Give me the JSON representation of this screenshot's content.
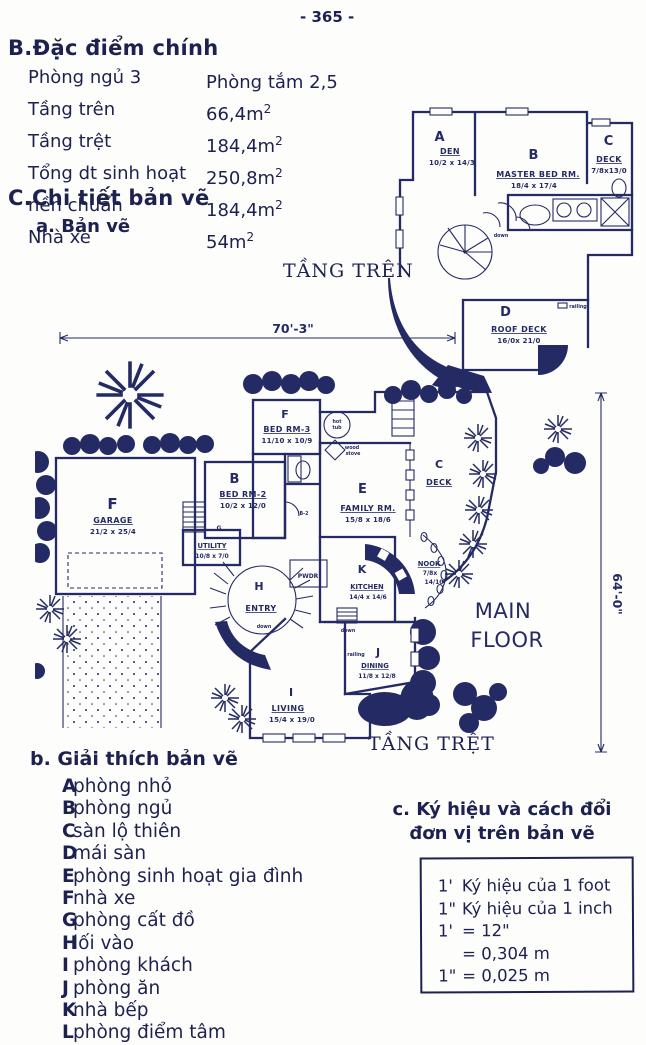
{
  "page": {
    "number": "- 365 -"
  },
  "section_b": {
    "title": "B.Đặc điểm chính",
    "rows": [
      {
        "label": "Phòng ngủ 3",
        "value": "Phòng tắm 2,5",
        "sup": ""
      },
      {
        "label": "Tầng trên",
        "value": "66,4m",
        "sup": "2"
      },
      {
        "label": "Tầng trệt",
        "value": "184,4m",
        "sup": "2"
      },
      {
        "label": "Tổng dt sinh hoạt",
        "value": "250,8m",
        "sup": "2"
      },
      {
        "label": "nền chuẩn",
        "value": "184,4m",
        "sup": "2"
      },
      {
        "label": "Nhà xe",
        "value": "54m",
        "sup": "2"
      }
    ]
  },
  "section_c": {
    "title": "C.Chi tiết bản vẽ",
    "sub_a": "a. Bản vẽ"
  },
  "upper_plan": {
    "floor_label": "TẦNG TRÊN",
    "rooms": [
      {
        "letter": "A",
        "name": "DEN",
        "dims": "10/2 x 14/3"
      },
      {
        "letter": "B",
        "name": "MASTER BED RM.",
        "dims": "18/4 x 17/4"
      },
      {
        "letter": "C",
        "name": "DECK",
        "dims": "7/8x13/0"
      },
      {
        "letter": "D",
        "name": "ROOF DECK",
        "dims": "16/0x 21/0"
      }
    ],
    "notes": {
      "railing": "railing",
      "down": "down"
    }
  },
  "main_plan": {
    "floor_label": "TẦNG TRỆT",
    "plan_title_1": "MAIN",
    "plan_title_2": "FLOOR",
    "width_dim": "70'-3\"",
    "height_dim": "64'-0\"",
    "rooms": [
      {
        "letter": "F",
        "name": "GARAGE",
        "dims": "21/2 x 25/4"
      },
      {
        "letter": "B",
        "name": "BED RM-2",
        "dims": "10/2 x 12/0"
      },
      {
        "letter": "F",
        "name": "BED RM-3",
        "dims": "11/10 x 10/9"
      },
      {
        "letter": "E",
        "name": "FAMILY RM.",
        "dims": "15/8 x 18/6"
      },
      {
        "letter": "C",
        "name": "DECK",
        "dims": ""
      },
      {
        "letter": "G",
        "name": "UTILITY",
        "dims": "10/8 x 7/0"
      },
      {
        "letter": "H",
        "name": "ENTRY",
        "dims": ""
      },
      {
        "letter": "K",
        "name": "KITCHEN",
        "dims": "14/4 x 14/6"
      },
      {
        "letter": "",
        "name": "NOOK",
        "dims_a": "7/8x",
        "dims_b": "14/10"
      },
      {
        "letter": "J",
        "name": "DINING",
        "dims": "11/8 x 12/8"
      },
      {
        "letter": "I",
        "name": "LIVING",
        "dims": "15/4 x 19/0"
      },
      {
        "letter": "",
        "name": "PWDR",
        "dims": ""
      }
    ],
    "labels": {
      "hot": "hot",
      "tub": "tub",
      "wood": "wood",
      "stove": "stove",
      "down1": "down",
      "down2": "down",
      "railing": "railing",
      "b2": "B-2"
    }
  },
  "legend": {
    "title": "b. Giải thích bản vẽ",
    "items": [
      {
        "key": "A",
        "label": "phòng nhỏ"
      },
      {
        "key": "B",
        "label": "phòng ngủ"
      },
      {
        "key": "C",
        "label": "sàn lộ thiên"
      },
      {
        "key": "D",
        "label": "mái sàn"
      },
      {
        "key": "E",
        "label": "phòng sinh hoạt gia đình"
      },
      {
        "key": "F",
        "label": "nhà xe"
      },
      {
        "key": "G",
        "label": "phòng cất đồ"
      },
      {
        "key": "H",
        "label": "lối vào"
      },
      {
        "key": "I",
        "label": "phòng khách"
      },
      {
        "key": "J",
        "label": "phòng ăn"
      },
      {
        "key": "K",
        "label": "nhà bếp"
      },
      {
        "key": "L",
        "label": "phòng điểm tâm"
      }
    ]
  },
  "section_c2": {
    "title_line1": "c. Ký hiệu và cách đổi",
    "title_line2": "đơn vị trên bản vẽ",
    "box_lines": [
      {
        "pre": "1'",
        "rest": "Ký hiệu của 1 foot"
      },
      {
        "pre": "1\"",
        "rest": "Ký hiệu của 1 inch"
      },
      {
        "pre": "1'",
        "rest": "= 12\""
      },
      {
        "pre": "",
        "rest": "= 0,304 m"
      },
      {
        "pre": "1\"",
        "rest": "= 0,025 m"
      }
    ]
  }
}
